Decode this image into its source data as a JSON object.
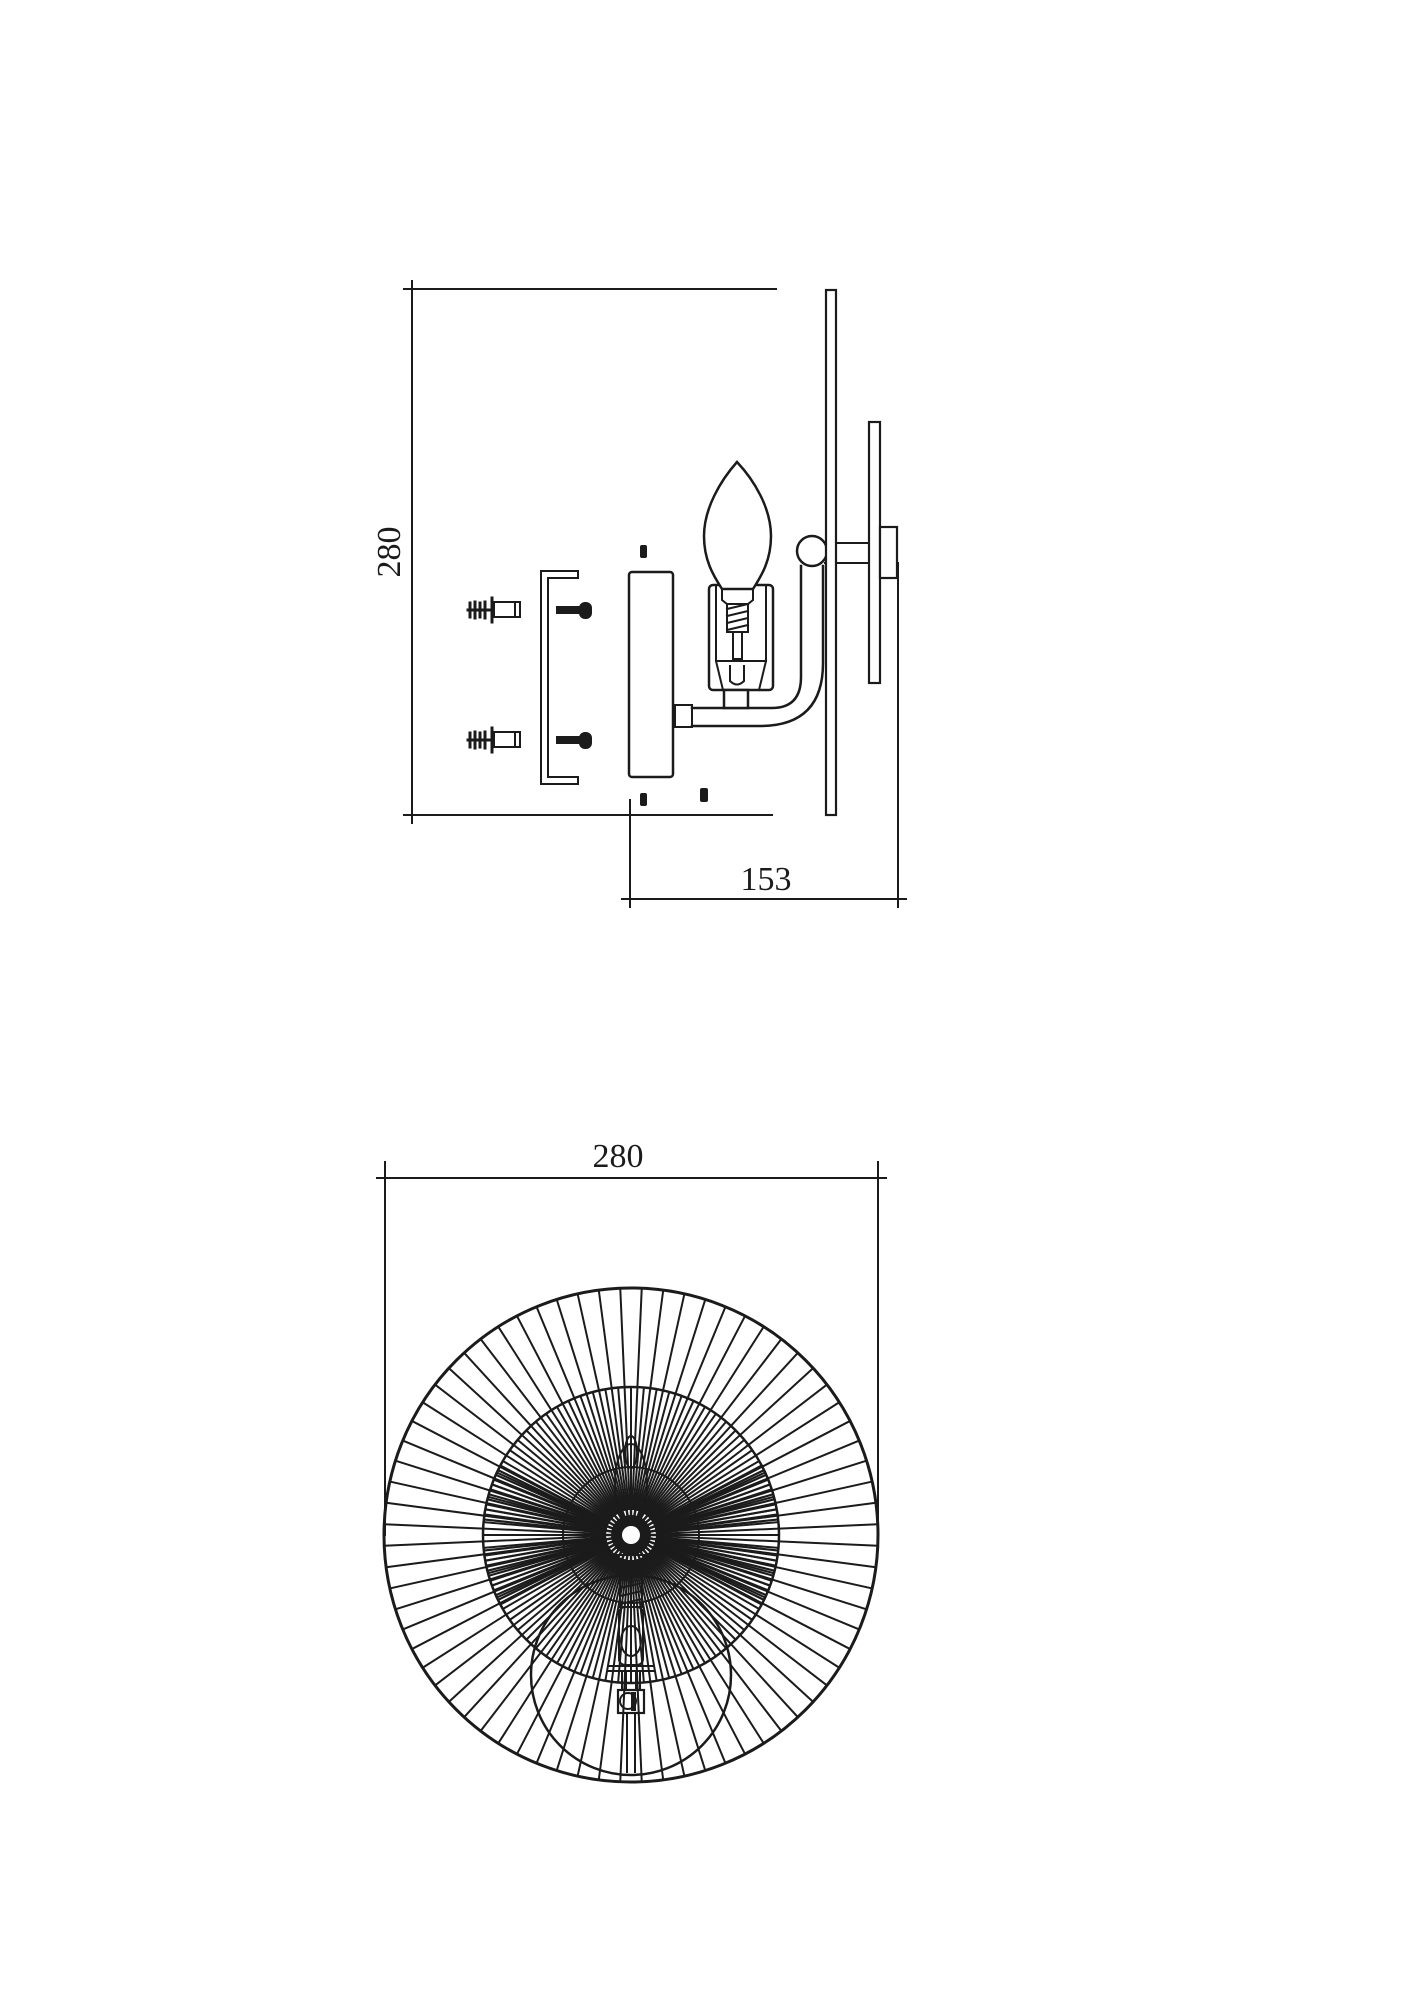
{
  "drawing": {
    "background": "#ffffff",
    "line_color": "#1b1b1b",
    "side_view": {
      "height_label": "280",
      "depth_label": "153"
    },
    "front_view": {
      "width_label": "280"
    }
  }
}
